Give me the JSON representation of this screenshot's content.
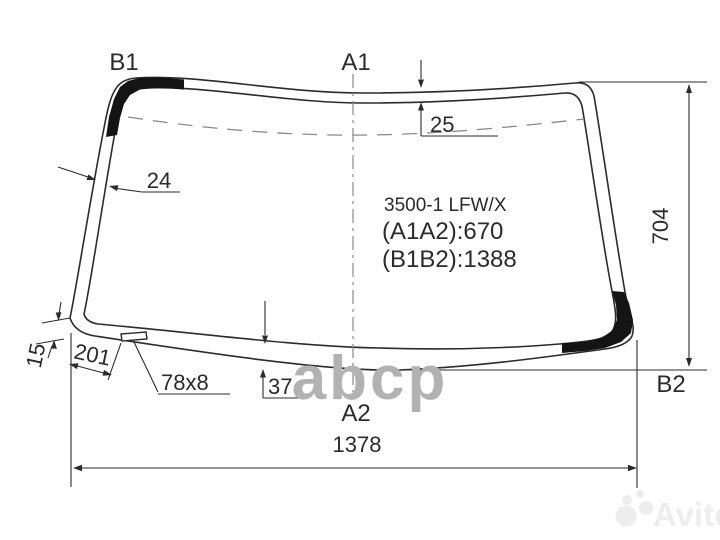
{
  "title_block": {
    "part_number": "3500-1 LFW/X",
    "a1a2": "(A1A2):670",
    "b1b2": "(B1B2):1388"
  },
  "corner_labels": {
    "b1": "B1",
    "a1": "A1",
    "a2": "A2",
    "b2": "B2"
  },
  "dimensions": {
    "top_band_width": "25",
    "left_band_width": "24",
    "glass_height": "704",
    "left_corner_band_width": "15",
    "slot_offset": "201",
    "slot_size": "78x8",
    "bottom_band_width": "37",
    "glass_width": "1378"
  },
  "watermarks": {
    "center": "abcp",
    "bottom_right": "Avito"
  },
  "colors": {
    "line": "#2b2b2b",
    "guide": "#8a8a8a",
    "black_band": "#141414",
    "watermark_center": "#b2b2b2",
    "watermark_corner": "#ededed",
    "background": "#ffffff"
  }
}
